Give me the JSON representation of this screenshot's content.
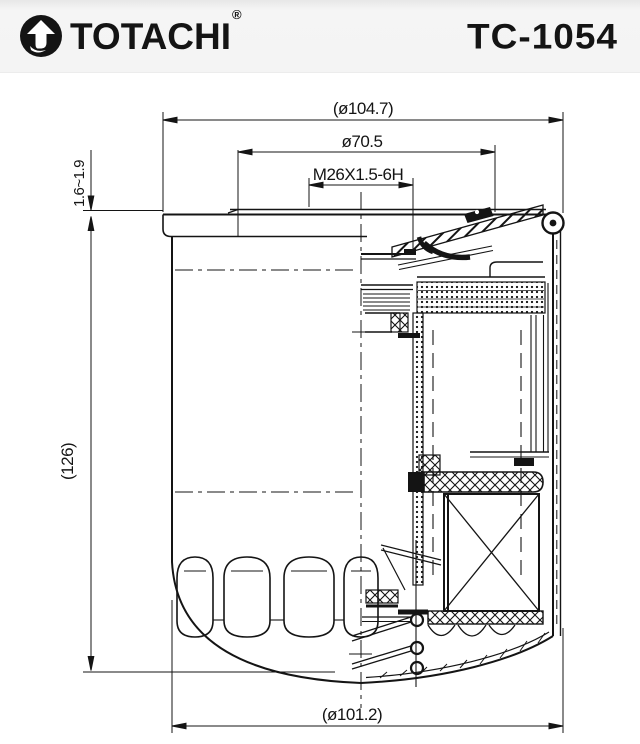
{
  "header": {
    "brand": "TOTACHI",
    "registered_mark": "®",
    "model_code": "TC-1054"
  },
  "drawing": {
    "type": "oil-filter-cross-section-technical-drawing",
    "dimensions": {
      "top_outer_diameter": "(ø104.7)",
      "plate_pilot_diameter": "ø70.5",
      "thread_spec": "M26X1.5-6H",
      "seam_height_range": "1.6~1.9",
      "overall_height": "(126)",
      "body_diameter": "(ø101.2)"
    },
    "line_color": "#141414",
    "background_color": "#ffffff",
    "header_background_color": "#f4f4f4"
  }
}
